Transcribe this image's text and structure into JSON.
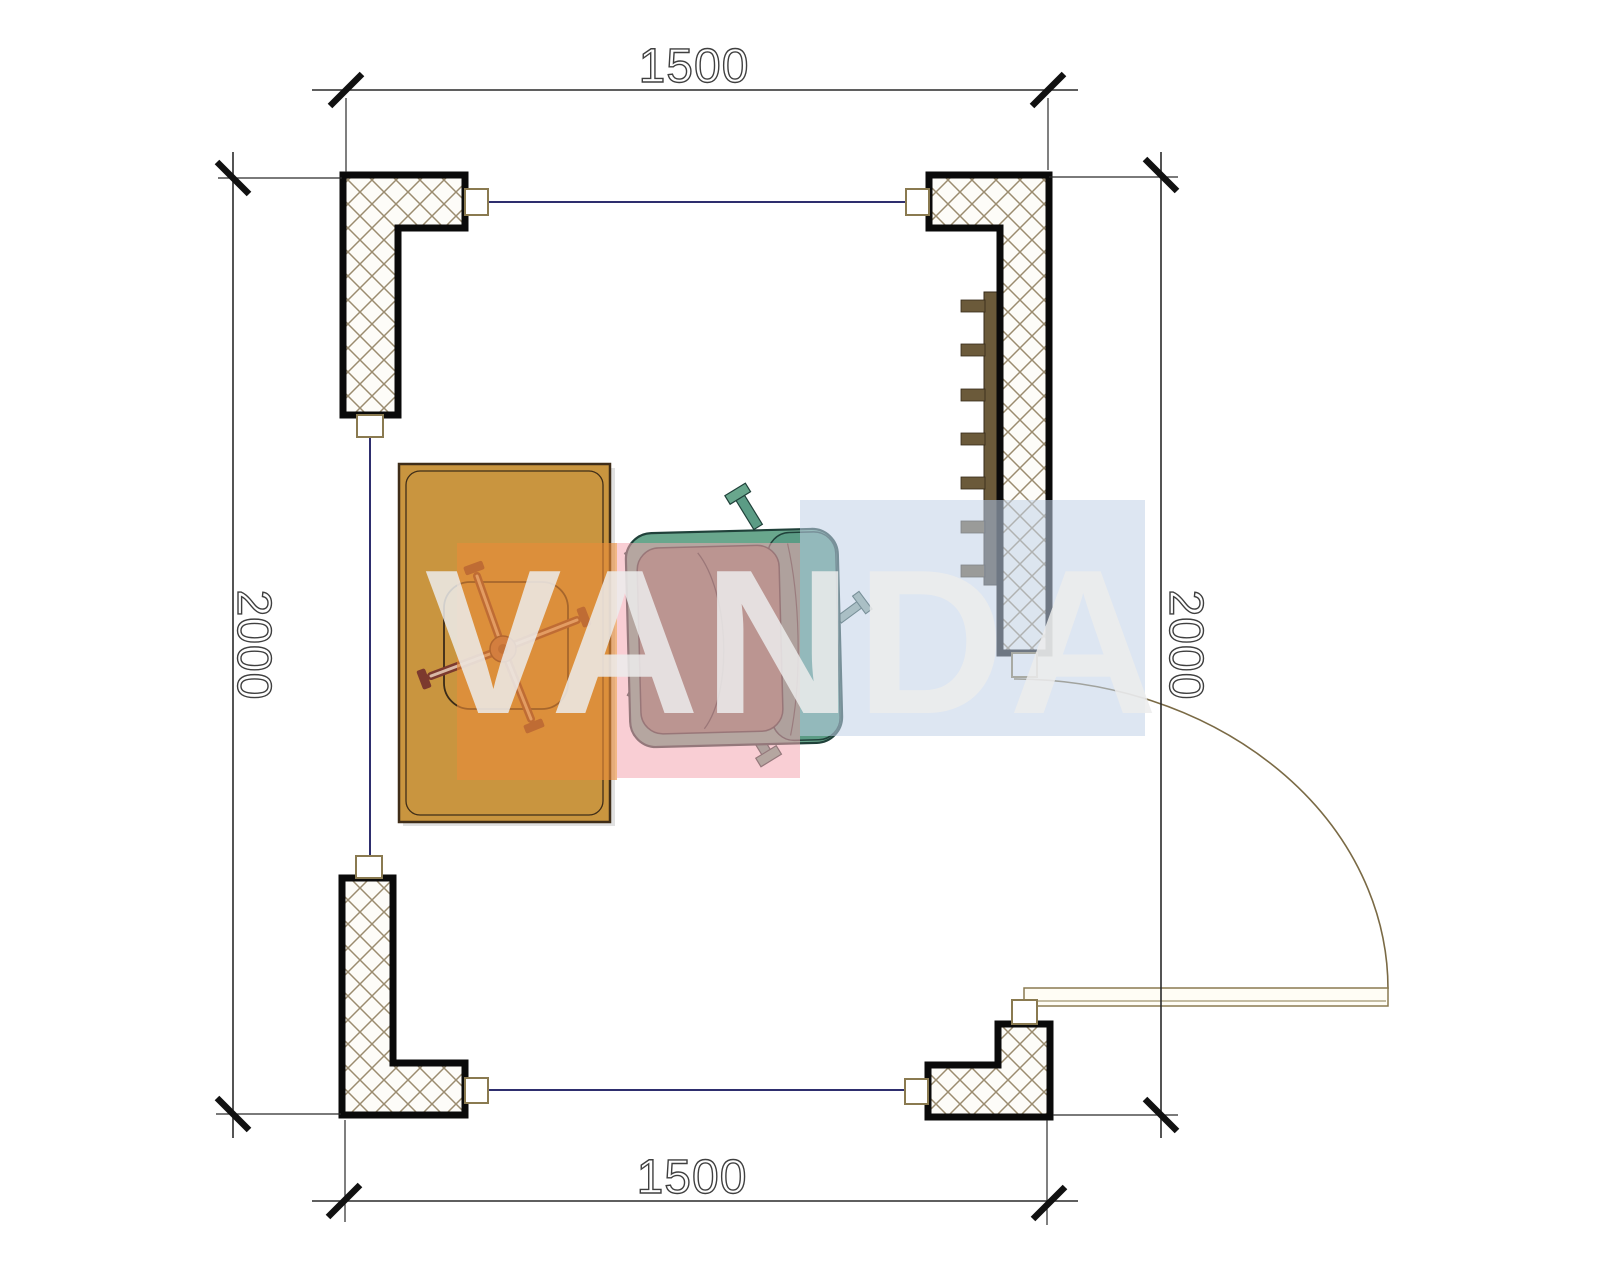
{
  "dimensions": {
    "top": "1500",
    "bottom": "1500",
    "left": "2000",
    "right": "2000"
  },
  "watermark": {
    "text": "VANDA",
    "block_colors": [
      "#E88A38",
      "#F4A6B1",
      "#C1D1E7"
    ]
  },
  "colors": {
    "desk_fill": "#C9953F",
    "desk_line": "#3F2D18",
    "chair_base": "#7C3A2E",
    "chair_base_light": "#D9B8A5",
    "chair_seat_line": "#3A2A18",
    "armchair_body": "#69A78D",
    "armchair_back": "#5B9C85",
    "armchair_cushion": "#75806A",
    "armchair_line": "#20413A",
    "radiator": "#6B5A3A",
    "wall_border": "#0A0A0A",
    "hatch_line": "#9B8C6F",
    "connector_line": "#8A7A50",
    "window_line": "#2E2E6E",
    "door_line": "#7A6A45",
    "dim_line": "#2A2A2A",
    "dim_text": "#3F3F3F",
    "wm_orange": "rgba(232,138,56,0.62)",
    "wm_pink": "rgba(244,166,177,0.55)",
    "wm_blue": "rgba(193,209,231,0.55)",
    "wm_letters": "#ECECEC"
  }
}
